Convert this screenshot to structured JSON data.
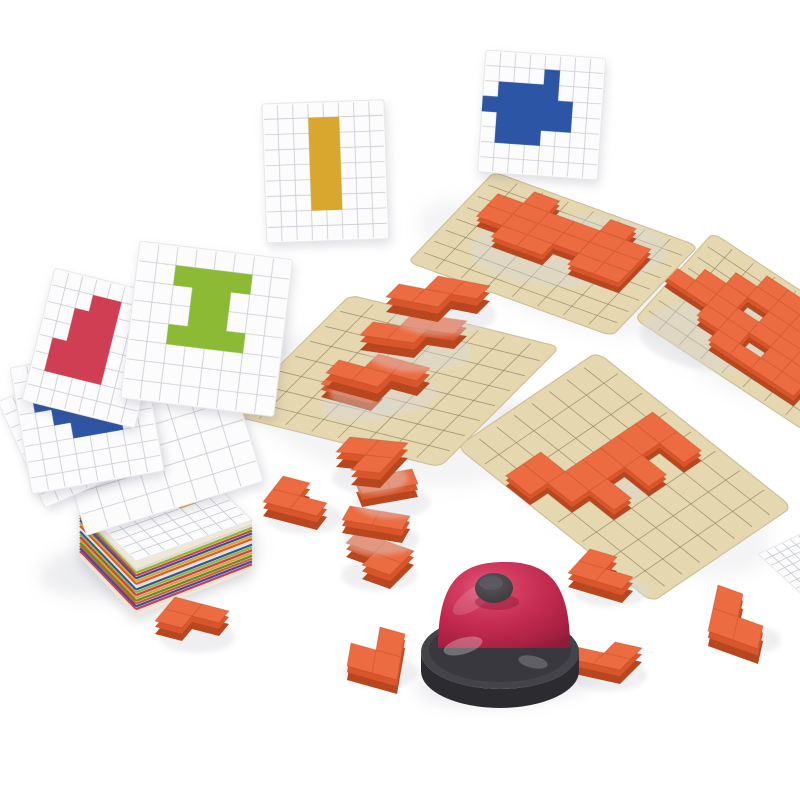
{
  "scene": {
    "width": 800,
    "height": 800,
    "background": "#ffffff",
    "description": "product photo of a pixel-block puzzle game: pattern cards, wooden grid boards with orange blocks, scattered orange L-blocks, card stack and a red service bell"
  },
  "palette": {
    "card_bg": "#fcfcfd",
    "card_edge": "#e7e7ed",
    "card_grid": "#c7cad3",
    "board_fill": "#e5d7af",
    "board_edge": "#cfc098",
    "board_grid": "#8f8466",
    "block_top": "#ec6b41",
    "block_mid": "#d9562c",
    "block_dark": "#b8461e",
    "block_seam": "#9c3a10",
    "shadow": "#d8d9de",
    "blue": "#2d55a5",
    "green": "#8cba34",
    "red": "#cf3e52",
    "gold": "#d9a62e",
    "bell_dome_hi": "#e0607e",
    "bell_dome": "#c22a4e",
    "bell_dome_dark": "#8f1b39",
    "bell_base": "#44434a",
    "bell_base_dark": "#2c2b30",
    "bell_knob": "#454148",
    "bell_knob_hi": "#5e5a63",
    "stack_side": "#efe8d9"
  },
  "shadows": [
    {
      "cx": 560,
      "cy": 268,
      "rx": 150,
      "ry": 52,
      "rot": 20,
      "op": 0.28
    },
    {
      "cx": 735,
      "cy": 340,
      "rx": 100,
      "ry": 48,
      "rot": 30,
      "op": 0.26
    },
    {
      "cx": 385,
      "cy": 412,
      "rx": 150,
      "ry": 68,
      "rot": 14,
      "op": 0.28
    },
    {
      "cx": 628,
      "cy": 488,
      "rx": 155,
      "ry": 66,
      "rot": 26,
      "op": 0.28
    },
    {
      "cx": 150,
      "cy": 562,
      "rx": 112,
      "ry": 34,
      "rot": -8,
      "op": 0.45
    },
    {
      "cx": 508,
      "cy": 681,
      "rx": 92,
      "ry": 24,
      "rot": -5,
      "op": 0.55
    },
    {
      "cx": 210,
      "cy": 335,
      "rx": 88,
      "ry": 58,
      "rot": 10,
      "op": 0.22
    }
  ],
  "boards": [
    {
      "id": "puzzle-board-right",
      "o": [
        713,
        233
      ],
      "u": [
        170,
        112
      ],
      "v": [
        -78,
        86
      ],
      "piece": {
        "h": 10,
        "cells": [
          [
            3,
            1
          ],
          [
            4,
            1
          ],
          [
            2,
            2
          ],
          [
            3,
            2
          ],
          [
            4,
            2
          ],
          [
            5,
            2
          ],
          [
            1,
            3
          ],
          [
            2,
            3
          ],
          [
            4,
            3
          ],
          [
            5,
            3
          ],
          [
            0,
            4
          ],
          [
            1,
            4
          ],
          [
            2,
            4
          ],
          [
            3,
            4
          ],
          [
            4,
            4
          ],
          [
            5,
            4
          ],
          [
            6,
            4
          ],
          [
            2,
            5
          ],
          [
            3,
            5
          ],
          [
            5,
            5
          ],
          [
            6,
            5
          ],
          [
            3,
            6
          ],
          [
            4,
            6
          ],
          [
            5,
            6
          ],
          [
            6,
            6
          ]
        ]
      }
    },
    {
      "id": "puzzle-board-top",
      "o": [
        494,
        172
      ],
      "u": [
        204,
        74
      ],
      "v": [
        -86,
        90
      ],
      "piece": {
        "h": 10,
        "cells": [
          [
            2,
            1
          ],
          [
            5,
            1
          ],
          [
            1,
            2
          ],
          [
            2,
            2
          ],
          [
            3,
            2
          ],
          [
            4,
            2
          ],
          [
            5,
            2
          ],
          [
            6,
            2
          ],
          [
            1,
            3
          ],
          [
            2,
            3
          ],
          [
            3,
            3
          ],
          [
            4,
            3
          ],
          [
            5,
            3
          ],
          [
            6,
            3
          ],
          [
            2,
            4
          ],
          [
            3,
            4
          ],
          [
            5,
            4
          ],
          [
            6,
            4
          ]
        ]
      }
    },
    {
      "id": "puzzle-board-bottom",
      "o": [
        597,
        352
      ],
      "u": [
        195,
        155
      ],
      "v": [
        -140,
        95
      ],
      "piece": {
        "h": 10,
        "cells": [
          [
            4,
            1
          ],
          [
            3,
            1
          ],
          [
            3,
            2
          ],
          [
            4,
            3
          ],
          [
            3,
            3
          ],
          [
            3,
            4
          ],
          [
            4,
            5
          ],
          [
            3,
            5
          ],
          [
            3,
            6
          ],
          [
            2,
            6
          ],
          [
            2,
            7
          ]
        ]
      }
    },
    {
      "id": "puzzle-board-left",
      "o": [
        350,
        295
      ],
      "u": [
        210,
        52
      ],
      "v": [
        -120,
        120
      ],
      "piece": null
    }
  ],
  "stair_pieces": [
    {
      "id": "stair-block-bottom-end",
      "o": [
        333,
        385
      ],
      "u": [
        25,
        7
      ],
      "v": [
        -12,
        12
      ],
      "h": 13,
      "cells": [
        [
          0,
          0
        ],
        [
          1,
          0
        ]
      ]
    },
    {
      "id": "stair-block-1",
      "o": [
        352,
        362
      ],
      "u": [
        26,
        7
      ],
      "v": [
        -13,
        13
      ],
      "h": 15,
      "cells": [
        [
          1,
          0
        ],
        [
          2,
          0
        ],
        [
          0,
          1
        ],
        [
          1,
          1
        ]
      ]
    },
    {
      "id": "stair-block-2",
      "o": [
        386,
        324
      ],
      "u": [
        27,
        4
      ],
      "v": [
        -13,
        13
      ],
      "h": 15,
      "cells": [
        [
          1,
          0
        ],
        [
          2,
          0
        ],
        [
          0,
          1
        ],
        [
          1,
          1
        ]
      ]
    },
    {
      "id": "stair-block-3",
      "o": [
        412,
        286
      ],
      "u": [
        26,
        5
      ],
      "v": [
        -13,
        13
      ],
      "h": 15,
      "cells": [
        [
          1,
          0
        ],
        [
          2,
          0
        ],
        [
          0,
          1
        ],
        [
          1,
          1
        ]
      ]
    }
  ],
  "flat_cards": [
    {
      "id": "pattern-card-corner",
      "o": [
        758,
        554
      ],
      "u": [
        64,
        -30
      ],
      "v": [
        50,
        46
      ]
    }
  ],
  "cards_floating": [
    {
      "id": "pattern-card-blue",
      "x": 486,
      "y": 50,
      "w": 120,
      "h": 122,
      "rot": 4,
      "cols": 8,
      "rows": 8,
      "color": "blue",
      "cells": [
        [
          4,
          1
        ],
        [
          1,
          2
        ],
        [
          2,
          2
        ],
        [
          3,
          2
        ],
        [
          4,
          2
        ],
        [
          0,
          3
        ],
        [
          1,
          3
        ],
        [
          2,
          3
        ],
        [
          3,
          3
        ],
        [
          4,
          3
        ],
        [
          5,
          3
        ],
        [
          1,
          4
        ],
        [
          2,
          4
        ],
        [
          3,
          4
        ],
        [
          4,
          4
        ],
        [
          5,
          4
        ],
        [
          1,
          5
        ],
        [
          2,
          5
        ],
        [
          3,
          5
        ]
      ]
    },
    {
      "id": "pattern-card-yellow",
      "x": 262,
      "y": 104,
      "w": 122,
      "h": 139,
      "rot": -2,
      "cols": 8,
      "rows": 9,
      "color": "gold",
      "cells": [
        [
          3,
          1
        ],
        [
          4,
          1
        ],
        [
          3,
          2
        ],
        [
          4,
          2
        ],
        [
          3,
          3
        ],
        [
          4,
          3
        ],
        [
          3,
          4
        ],
        [
          4,
          4
        ],
        [
          3,
          5
        ],
        [
          4,
          5
        ],
        [
          3,
          6
        ],
        [
          4,
          6
        ]
      ]
    }
  ],
  "stack": {
    "id": "card-stack",
    "o": [
      80,
      507
    ],
    "u": [
      116,
      -41
    ],
    "v": [
      56,
      54
    ],
    "height": 50,
    "plus_color": "gold",
    "plus_cells": [
      [
        5,
        1
      ],
      [
        4,
        2
      ],
      [
        5,
        2
      ],
      [
        6,
        2
      ],
      [
        5,
        3
      ]
    ],
    "stripes": [
      "#dfd9c8",
      "#8cba34",
      "#cf3e52",
      "#2d55a5",
      "#d9a62e",
      "#e2572c",
      "#e8e2d2",
      "#2d55a5",
      "#8cba34",
      "#cf3e52",
      "#d9a62e",
      "#5a8f3c",
      "#e2572c",
      "#2d55a5",
      "#cf3e52",
      "#e8e2d2"
    ]
  },
  "cards_fan": [
    {
      "id": "pattern-card-white",
      "x": 55,
      "y": 432,
      "w": 185,
      "h": 108,
      "rot": -17,
      "cols": 8,
      "rows": 5,
      "color": "gold",
      "cells": []
    },
    {
      "id": "pattern-card-yellow-2",
      "x": -2,
      "y": 402,
      "w": 124,
      "h": 116,
      "rot": -24,
      "cols": 8,
      "rows": 8,
      "color": "gold",
      "cells": [
        [
          4,
          2
        ],
        [
          5,
          2
        ],
        [
          4,
          3
        ],
        [
          5,
          3
        ]
      ]
    },
    {
      "id": "pattern-card-blue-2",
      "x": 10,
      "y": 368,
      "w": 134,
      "h": 128,
      "rot": -10,
      "cols": 8,
      "rows": 8,
      "color": "blue",
      "cells": [
        [
          2,
          1
        ],
        [
          3,
          1
        ],
        [
          1,
          2
        ],
        [
          2,
          2
        ],
        [
          3,
          2
        ],
        [
          4,
          2
        ],
        [
          2,
          3
        ],
        [
          3,
          3
        ],
        [
          4,
          3
        ],
        [
          5,
          3
        ],
        [
          3,
          4
        ],
        [
          4,
          4
        ],
        [
          5,
          4
        ]
      ]
    },
    {
      "id": "pattern-card-red",
      "x": 55,
      "y": 268,
      "w": 116,
      "h": 136,
      "rot": 14,
      "cols": 8,
      "rows": 8,
      "color": "red",
      "cells": [
        [
          3,
          1
        ],
        [
          4,
          1
        ],
        [
          2,
          2
        ],
        [
          3,
          2
        ],
        [
          4,
          2
        ],
        [
          2,
          3
        ],
        [
          3,
          3
        ],
        [
          4,
          3
        ],
        [
          1,
          4
        ],
        [
          2,
          4
        ],
        [
          3,
          4
        ],
        [
          4,
          4
        ],
        [
          1,
          5
        ],
        [
          2,
          5
        ],
        [
          3,
          5
        ],
        [
          4,
          5
        ]
      ]
    },
    {
      "id": "pattern-card-green",
      "x": 140,
      "y": 241,
      "w": 154,
      "h": 158,
      "rot": 7,
      "cols": 8,
      "rows": 8,
      "color": "green",
      "cells": [
        [
          2,
          1
        ],
        [
          3,
          1
        ],
        [
          4,
          1
        ],
        [
          5,
          1
        ],
        [
          3,
          2
        ],
        [
          4,
          2
        ],
        [
          3,
          3
        ],
        [
          4,
          3
        ],
        [
          2,
          4
        ],
        [
          3,
          4
        ],
        [
          4,
          4
        ],
        [
          5,
          4
        ]
      ]
    }
  ],
  "blocks": [
    {
      "id": "orange-block-left",
      "o": [
        283,
        490
      ],
      "u": [
        27,
        7
      ],
      "v": [
        -10,
        13
      ],
      "h": 14,
      "cells": [
        [
          0,
          0
        ],
        [
          0,
          1
        ],
        [
          1,
          1
        ]
      ]
    },
    {
      "id": "tower-block-4",
      "o": [
        358,
        545
      ],
      "u": [
        28,
        10
      ],
      "v": [
        -12,
        12
      ],
      "h": 14,
      "cells": [
        [
          0,
          0
        ],
        [
          1,
          0
        ],
        [
          1,
          1
        ]
      ]
    },
    {
      "id": "tower-block-3",
      "o": [
        350,
        519
      ],
      "u": [
        30,
        5
      ],
      "v": [
        -8,
        14
      ],
      "h": 13,
      "cells": [
        [
          0,
          0
        ],
        [
          1,
          0
        ]
      ]
    },
    {
      "id": "tower-block-2",
      "o": [
        356,
        492
      ],
      "u": [
        28,
        -5
      ],
      "v": [
        6,
        15
      ],
      "h": 13,
      "cells": [
        [
          0,
          0
        ],
        [
          1,
          0
        ]
      ]
    },
    {
      "id": "tower-block-1",
      "o": [
        350,
        452
      ],
      "u": [
        29,
        3
      ],
      "v": [
        -14,
        15
      ],
      "h": 15,
      "cells": [
        [
          0,
          0
        ],
        [
          1,
          0
        ],
        [
          1,
          1
        ]
      ]
    },
    {
      "id": "orange-block-flat",
      "o": [
        175,
        610
      ],
      "u": [
        27,
        7
      ],
      "v": [
        -10,
        12
      ],
      "h": 13,
      "cells": [
        [
          0,
          0
        ],
        [
          1,
          0
        ],
        [
          0,
          1
        ]
      ]
    },
    {
      "id": "orange-block-standing-center",
      "o": [
        355,
        634
      ],
      "u": [
        25,
        7
      ],
      "v": [
        -4,
        23
      ],
      "h": 14,
      "cells": [
        [
          1,
          0
        ],
        [
          1,
          1
        ],
        [
          0,
          1
        ]
      ]
    },
    {
      "id": "orange-block-right-of-bell",
      "o": [
        590,
        563
      ],
      "u": [
        27,
        8
      ],
      "v": [
        -11,
        12
      ],
      "h": 14,
      "cells": [
        [
          0,
          0
        ],
        [
          0,
          1
        ],
        [
          1,
          1
        ]
      ]
    },
    {
      "id": "orange-block-below-bell",
      "o": [
        588,
        650
      ],
      "u": [
        27,
        6
      ],
      "v": [
        -11,
        11
      ],
      "h": 14,
      "cells": [
        [
          1,
          0
        ],
        [
          1,
          1
        ],
        [
          0,
          1
        ]
      ]
    },
    {
      "id": "orange-block-standing-right",
      "o": [
        718,
        600
      ],
      "u": [
        25,
        9
      ],
      "v": [
        -5,
        23
      ],
      "h": 15,
      "cells": [
        [
          0,
          0
        ],
        [
          0,
          1
        ],
        [
          1,
          1
        ]
      ]
    }
  ],
  "bell": {
    "id": "service-bell",
    "dome_cx": 504,
    "dome_top": 562,
    "dome_rx": 66,
    "dome_base_y": 648,
    "base_cx": 500,
    "base_cy": 652,
    "base_rx": 79,
    "base_ry": 37,
    "base_h": 19,
    "knob_cx": 494,
    "knob_cy": 588,
    "knob_rx": 19,
    "knob_ry": 15
  }
}
